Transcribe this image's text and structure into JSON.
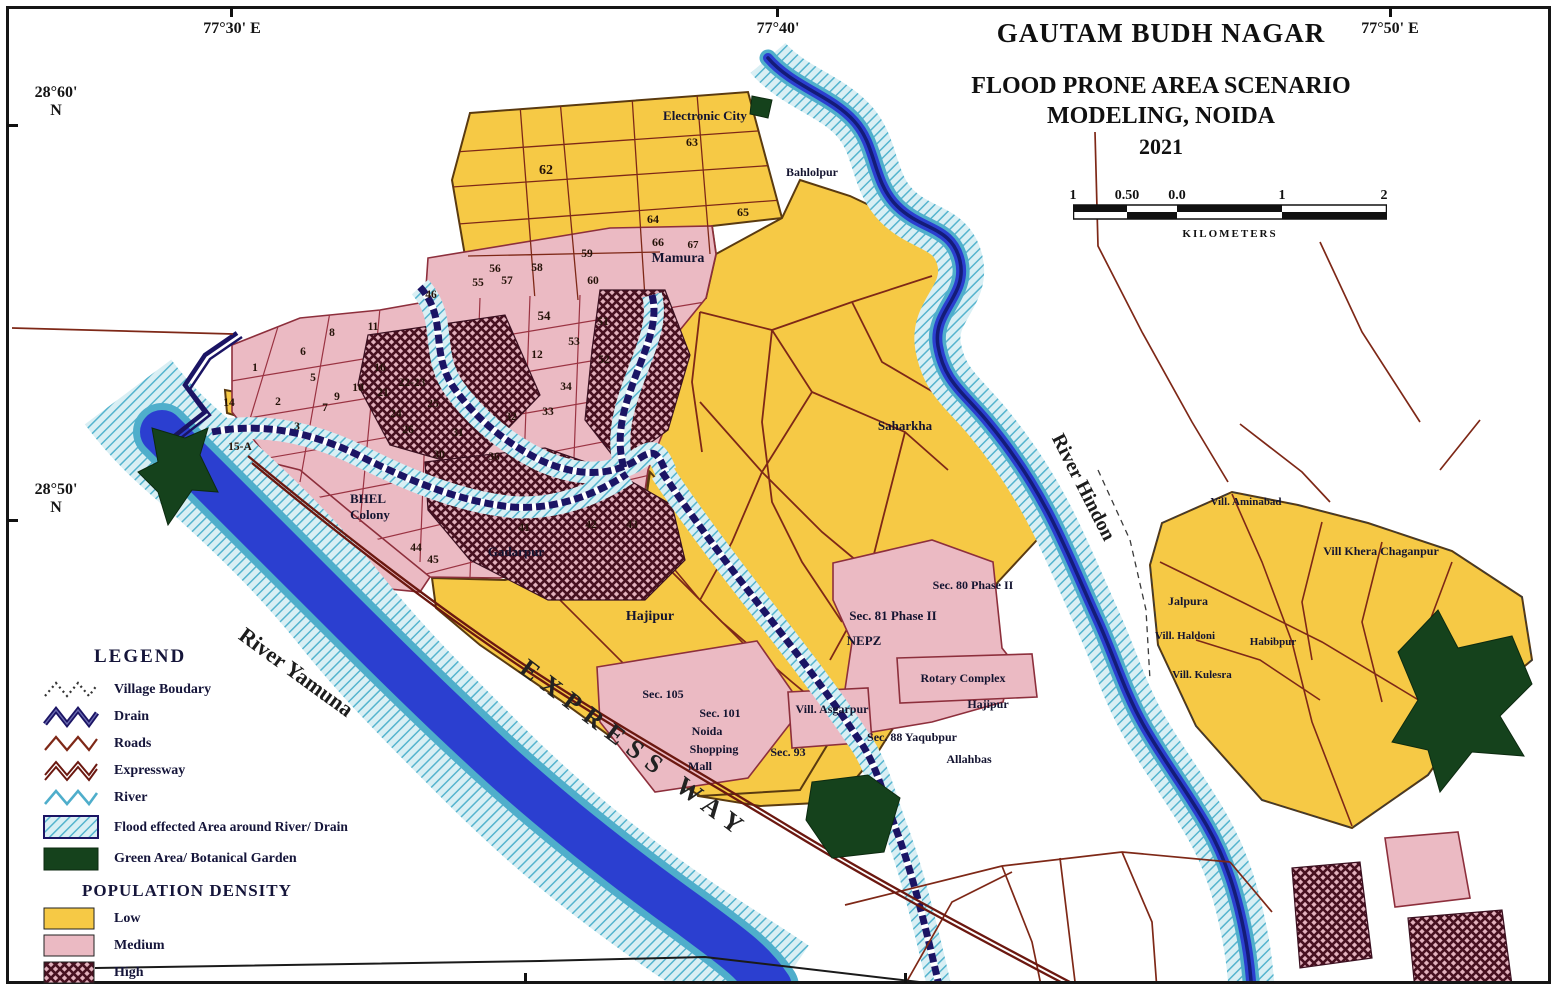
{
  "header": {
    "region_title": "GAUTAM BUDH NAGAR",
    "title_line1": "FLOOD PRONE AREA SCENARIO",
    "title_line2": "MODELING, NOIDA",
    "year": "2021"
  },
  "scale_bar": {
    "labels": [
      "1",
      "0.50",
      "0.0",
      "1",
      "2"
    ],
    "unit": "KILOMETERS"
  },
  "coordinates": {
    "top": [
      {
        "text": "77°30' E",
        "x": 232
      },
      {
        "text": "77°40'",
        "x": 778
      },
      {
        "text": "77°50' E",
        "x": 1390
      }
    ],
    "left": [
      {
        "deg": "28°60'",
        "ns": "N",
        "y": 100
      },
      {
        "deg": "28°50'",
        "ns": "N",
        "y": 497
      }
    ]
  },
  "legend": {
    "heading": "LEGEND",
    "items": [
      {
        "name": "village-boundary",
        "label": "Village Boudary"
      },
      {
        "name": "drain",
        "label": "Drain"
      },
      {
        "name": "roads",
        "label": "Roads"
      },
      {
        "name": "expressway",
        "label": "Expressway"
      },
      {
        "name": "river",
        "label": "River"
      },
      {
        "name": "flood-area",
        "label": "Flood effected Area around River/ Drain"
      },
      {
        "name": "green-area",
        "label": "Green Area/ Botanical Garden"
      }
    ],
    "density_heading": "POPULATION DENSITY",
    "density_items": [
      {
        "name": "low",
        "label": "Low"
      },
      {
        "name": "medium",
        "label": "Medium"
      },
      {
        "name": "high",
        "label": "High"
      }
    ]
  },
  "map_labels": [
    {
      "t": "Electronic City",
      "x": 705,
      "y": 120,
      "s": 13
    },
    {
      "t": "Bahlolpur",
      "x": 812,
      "y": 176,
      "s": 12
    },
    {
      "t": "Mamura",
      "x": 678,
      "y": 262,
      "s": 14
    },
    {
      "t": "Saharkha",
      "x": 905,
      "y": 430,
      "s": 13
    },
    {
      "t": "BHEL",
      "x": 368,
      "y": 503,
      "s": 13
    },
    {
      "t": "Colony",
      "x": 370,
      "y": 519,
      "s": 13
    },
    {
      "t": "Gadarpur",
      "x": 516,
      "y": 556,
      "s": 13
    },
    {
      "t": "Hajipur",
      "x": 650,
      "y": 620,
      "s": 14
    },
    {
      "t": "Sec. 105",
      "x": 663,
      "y": 698,
      "s": 12
    },
    {
      "t": "Sec. 101",
      "x": 720,
      "y": 717,
      "s": 12
    },
    {
      "t": "Noida",
      "x": 707,
      "y": 735,
      "s": 12
    },
    {
      "t": "Shopping",
      "x": 714,
      "y": 753,
      "s": 12
    },
    {
      "t": "Mall",
      "x": 700,
      "y": 770,
      "s": 12
    },
    {
      "t": "Sec. 93",
      "x": 788,
      "y": 756,
      "s": 12
    },
    {
      "t": "Vill. Asgarpur",
      "x": 832,
      "y": 713,
      "s": 12
    },
    {
      "t": "Sec. 81 Phase II",
      "x": 893,
      "y": 620,
      "s": 13
    },
    {
      "t": "NEPZ",
      "x": 864,
      "y": 645,
      "s": 13
    },
    {
      "t": "Sec. 80 Phase II",
      "x": 973,
      "y": 589,
      "s": 12
    },
    {
      "t": "Rotary Complex",
      "x": 963,
      "y": 682,
      "s": 12
    },
    {
      "t": "Hajipur",
      "x": 988,
      "y": 708,
      "s": 12
    },
    {
      "t": "Sec. 88 Yaqubpur",
      "x": 912,
      "y": 741,
      "s": 12
    },
    {
      "t": "Allahbas",
      "x": 969,
      "y": 763,
      "s": 12
    },
    {
      "t": "Vill. Aminabad",
      "x": 1246,
      "y": 505,
      "s": 11
    },
    {
      "t": "Vill Khera Chaganpur",
      "x": 1381,
      "y": 555,
      "s": 12
    },
    {
      "t": "Jalpura",
      "x": 1188,
      "y": 605,
      "s": 12
    },
    {
      "t": "Vill. Haldoni",
      "x": 1185,
      "y": 639,
      "s": 11
    },
    {
      "t": "Habibpur",
      "x": 1273,
      "y": 645,
      "s": 11
    },
    {
      "t": "Vill. Kulesra",
      "x": 1202,
      "y": 678,
      "s": 11
    },
    {
      "t": "River Yamuna",
      "x": 292,
      "y": 678,
      "s": 22,
      "r": 36,
      "cls": "river"
    },
    {
      "t": "River Hindon",
      "x": 1078,
      "y": 490,
      "s": 20,
      "r": 63,
      "cls": "river"
    },
    {
      "t": "EXPRESS WAY",
      "x": 630,
      "y": 756,
      "s": 26,
      "r": 37,
      "cls": "exp"
    }
  ],
  "sector_numbers": [
    {
      "n": "1",
      "x": 255,
      "y": 371
    },
    {
      "n": "2",
      "x": 278,
      "y": 405
    },
    {
      "n": "3",
      "x": 297,
      "y": 430
    },
    {
      "n": "5",
      "x": 313,
      "y": 381
    },
    {
      "n": "6",
      "x": 303,
      "y": 355
    },
    {
      "n": "7",
      "x": 325,
      "y": 411
    },
    {
      "n": "8",
      "x": 332,
      "y": 336
    },
    {
      "n": "9",
      "x": 337,
      "y": 400
    },
    {
      "n": "10",
      "x": 358,
      "y": 391
    },
    {
      "n": "11",
      "x": 373,
      "y": 330
    },
    {
      "n": "12",
      "x": 537,
      "y": 358
    },
    {
      "n": "14",
      "x": 229,
      "y": 406
    },
    {
      "n": "15-A",
      "x": 240,
      "y": 450
    },
    {
      "n": "16",
      "x": 380,
      "y": 371
    },
    {
      "n": "21",
      "x": 383,
      "y": 396
    },
    {
      "n": "22-23",
      "x": 412,
      "y": 386
    },
    {
      "n": "24",
      "x": 396,
      "y": 417
    },
    {
      "n": "25",
      "x": 433,
      "y": 407
    },
    {
      "n": "26",
      "x": 408,
      "y": 433
    },
    {
      "n": "30",
      "x": 439,
      "y": 458
    },
    {
      "n": "31",
      "x": 458,
      "y": 436
    },
    {
      "n": "32",
      "x": 511,
      "y": 420
    },
    {
      "n": "33",
      "x": 548,
      "y": 415
    },
    {
      "n": "34",
      "x": 566,
      "y": 390
    },
    {
      "n": "36",
      "x": 494,
      "y": 460
    },
    {
      "n": "41",
      "x": 524,
      "y": 531
    },
    {
      "n": "42",
      "x": 591,
      "y": 528
    },
    {
      "n": "43",
      "x": 632,
      "y": 528
    },
    {
      "n": "44",
      "x": 416,
      "y": 551
    },
    {
      "n": "45",
      "x": 433,
      "y": 563
    },
    {
      "n": "46",
      "x": 431,
      "y": 298
    },
    {
      "n": "51",
      "x": 603,
      "y": 325
    },
    {
      "n": "52",
      "x": 604,
      "y": 363
    },
    {
      "n": "53",
      "x": 574,
      "y": 345
    },
    {
      "n": "54",
      "x": 544,
      "y": 320,
      "s": 13
    },
    {
      "n": "55",
      "x": 478,
      "y": 286
    },
    {
      "n": "56",
      "x": 495,
      "y": 272
    },
    {
      "n": "57",
      "x": 507,
      "y": 284
    },
    {
      "n": "58",
      "x": 537,
      "y": 271
    },
    {
      "n": "59",
      "x": 587,
      "y": 257
    },
    {
      "n": "60",
      "x": 593,
      "y": 284
    },
    {
      "n": "62",
      "x": 546,
      "y": 174,
      "s": 14
    },
    {
      "n": "63",
      "x": 692,
      "y": 146,
      "s": 12
    },
    {
      "n": "64",
      "x": 653,
      "y": 223,
      "s": 12
    },
    {
      "n": "65",
      "x": 743,
      "y": 216,
      "s": 12
    },
    {
      "n": "66",
      "x": 658,
      "y": 246,
      "s": 12
    },
    {
      "n": "67",
      "x": 693,
      "y": 248,
      "s": 11
    }
  ],
  "colors": {
    "low_density": "#F6C945",
    "medium_density": "#EBBAC3",
    "high_density_hatch": "#471120",
    "flood_background": "#D9EFF4",
    "flood_stripe": "#55B4CE",
    "river_core": "#2B3FD0",
    "river_edge": "#4FAECB",
    "drain": "#1B1464",
    "road": "#7E2817",
    "expressway": "#6B1810",
    "green_area": "#15421C"
  }
}
